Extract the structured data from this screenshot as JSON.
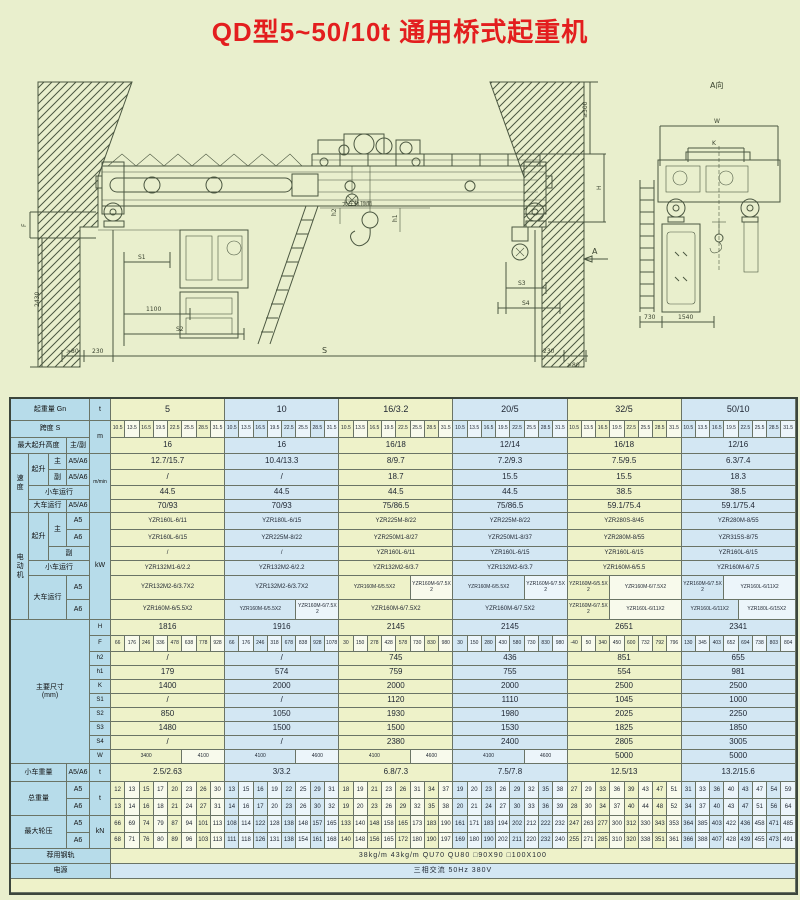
{
  "title": "QD型5~50/10t 通用桥式起重机",
  "drawing": {
    "view_a_label": "A向",
    "w": "W",
    "k": "K",
    "d730": "730",
    "d1540": "1540",
    "ge300": "≥300",
    "h": "H",
    "f": "F",
    "d2430": "2430",
    "s1": "S1",
    "d1100": "1100",
    "s2": "S2",
    "gt80l": ">80",
    "d230l": "230",
    "s": "S",
    "d230r": "230",
    "gt80r": ">80",
    "s3": "S3",
    "s4": "S4",
    "a": "A",
    "h1": "h1",
    "h2": "h2",
    "rail_top": "大车轨顶面"
  },
  "table": {
    "corner": {
      "capacity": "起重量 Gn"
    },
    "units": {
      "t": "t",
      "m": "m",
      "mmin": "m/min",
      "kw": "kW",
      "t2": "t",
      "t3": "t",
      "kn": "kN"
    },
    "labels": {
      "span": "跨度 S",
      "height": "最大起升高度",
      "main_aux": "主/副",
      "speed": "速度",
      "hoist": "起升",
      "main": "主",
      "aux": "副",
      "a56": "A5/A6",
      "a5": "A5",
      "a6": "A6",
      "trolley_travel": "小车运行",
      "crane_travel": "大车运行",
      "motor": "电动机",
      "dims": "主要尺寸\n(mm)",
      "trolley_weight": "小车重量",
      "total_weight": "总重量",
      "wheel_load": "最大轮压",
      "rail": "荐用钢轨",
      "power": "电源"
    },
    "dim_labels": [
      "H",
      "F",
      "h2",
      "h1",
      "K",
      "S1",
      "S2",
      "S3",
      "S4",
      "W"
    ],
    "spans": [
      "10.5",
      "13.5",
      "16.5",
      "19.5",
      "22.5",
      "25.5",
      "28.5",
      "31.5"
    ],
    "rows": {
      "capacities": [
        "5",
        "10",
        "16/3.2",
        "20/5",
        "32/5",
        "50/10"
      ],
      "height": [
        "16",
        "16",
        "16/18",
        "12/14",
        "16/18",
        "12/16"
      ],
      "speed_main": [
        "12.7/15.7",
        "10.4/13.3",
        "8/9.7",
        "7.2/9.3",
        "7.5/9.5",
        "6.3/7.4"
      ],
      "speed_aux": [
        "/",
        "/",
        "18.7",
        "15.5",
        "15.5",
        "18.3"
      ],
      "speed_trolley": [
        "44.5",
        "44.5",
        "44.5",
        "44.5",
        "38.5",
        "38.5"
      ],
      "speed_crane": [
        "70/93",
        "70/93",
        "75/86.5",
        "75/86.5",
        "59.1/75.4",
        "59.1/75.4"
      ],
      "motor_main_a5": [
        "YZR160L-6/11",
        "YZR180L-6/15",
        "YZR225M-8/22",
        "YZR225M-8/22",
        "YZR280S-8/45",
        "YZR280M-8/55"
      ],
      "motor_main_a6": [
        "YZR160L-6/15",
        "YZR225M-8/22",
        "YZR250M1-8/27",
        "YZR250M1-8/37",
        "YZR280M-8/55",
        "YZR315S-8/75"
      ],
      "motor_aux": [
        "/",
        "/",
        "YZR160L-6/11",
        "YZR160L-6/15",
        "YZR160L-6/15",
        "YZR160L-6/15"
      ],
      "motor_trolley": [
        "YZR132M1-6/2.2",
        "YZR132M2-6/2.2",
        "YZR132M2-6/3.7",
        "YZR132M2-6/3.7",
        "YZR160M-6/5.5",
        "YZR160M-6/7.5"
      ],
      "motor_crane_a5": [
        [
          "YZR132M2-6/3.7X2"
        ],
        [
          "YZR132M2-6/3.7X2"
        ],
        [
          "YZR160M-6/5.5X2",
          "YZR160M-6/7.5X2"
        ],
        [
          "YZR160M-6/5.5X2",
          "YZR160M-6/7.5X2"
        ],
        [
          "YZR160M-6/5.5X2",
          "YZR160M-6/7.5X2"
        ],
        [
          "YZR160M-6/7.5X2",
          "YZR160L-6/11X2"
        ]
      ],
      "motor_crane_a6": [
        [
          "YZR160M-6/5.5X2"
        ],
        [
          "YZR160M-6/5.5X2",
          "YZR160M-6/7.5X2"
        ],
        [
          "YZR160M-6/7.5X2"
        ],
        [
          "YZR160M-6/7.5X2"
        ],
        [
          "YZR160M-6/7.5X2",
          "YZR160L-6/11X2"
        ],
        [
          "YZR160L-6/11X2",
          "YZR180L-6/15X2"
        ]
      ],
      "H": [
        "1816",
        "1916",
        "2145",
        "2145",
        "2651",
        "2341"
      ],
      "F": [
        [
          "66",
          "176",
          "246",
          "336",
          "478",
          "638",
          "778",
          "928"
        ],
        [
          "66",
          "176",
          "246",
          "318",
          "678",
          "838",
          "928",
          "1078"
        ],
        [
          "30",
          "150",
          "278",
          "428",
          "578",
          "730",
          "830",
          "980"
        ],
        [
          "30",
          "150",
          "280",
          "430",
          "580",
          "730",
          "830",
          "980"
        ],
        [
          "-40",
          "50",
          "340",
          "450",
          "600",
          "732",
          "792",
          "796"
        ],
        [
          "130",
          "345",
          "403",
          "652",
          "694",
          "738",
          "803",
          "804"
        ]
      ],
      "h2": [
        "/",
        "/",
        "745",
        "436",
        "851",
        "655"
      ],
      "h1": [
        "179",
        "574",
        "759",
        "755",
        "554",
        "981"
      ],
      "K": [
        "1400",
        "2000",
        "2000",
        "2000",
        "2500",
        "2500"
      ],
      "S1": [
        "/",
        "/",
        "1120",
        "1110",
        "1045",
        "1000"
      ],
      "S2": [
        "850",
        "1050",
        "1930",
        "1980",
        "2025",
        "2250"
      ],
      "S3": [
        "1480",
        "1500",
        "1500",
        "1530",
        "1825",
        "1850"
      ],
      "S4": [
        "/",
        "/",
        "2380",
        "2400",
        "2805",
        "3005"
      ],
      "W": [
        [
          "3400",
          "4100"
        ],
        [
          "4100",
          "4600"
        ],
        [
          "4100",
          "4600"
        ],
        [
          "4100",
          "4600"
        ],
        [
          "5000"
        ],
        [
          "5000"
        ]
      ],
      "trolley_weight": [
        "2.5/2.63",
        "3/3.2",
        "6.8/7.3",
        "7.5/7.8",
        "12.5/13",
        "13.2/15.6"
      ],
      "total_a5": [
        [
          "12",
          "13",
          "15",
          "17",
          "20",
          "23",
          "26",
          "30"
        ],
        [
          "13",
          "15",
          "16",
          "19",
          "22",
          "25",
          "29",
          "31"
        ],
        [
          "18",
          "19",
          "21",
          "23",
          "26",
          "31",
          "34",
          "37"
        ],
        [
          "19",
          "20",
          "23",
          "26",
          "29",
          "32",
          "35",
          "38"
        ],
        [
          "27",
          "29",
          "33",
          "36",
          "39",
          "43",
          "47",
          "51"
        ],
        [
          "31",
          "33",
          "36",
          "40",
          "43",
          "47",
          "54",
          "59"
        ]
      ],
      "total_a6": [
        [
          "13",
          "14",
          "16",
          "18",
          "21",
          "24",
          "27",
          "31"
        ],
        [
          "14",
          "16",
          "17",
          "20",
          "23",
          "26",
          "30",
          "32"
        ],
        [
          "19",
          "20",
          "23",
          "26",
          "29",
          "32",
          "35",
          "38"
        ],
        [
          "20",
          "21",
          "24",
          "27",
          "30",
          "33",
          "36",
          "39"
        ],
        [
          "28",
          "30",
          "34",
          "37",
          "40",
          "44",
          "48",
          "52"
        ],
        [
          "34",
          "37",
          "40",
          "43",
          "47",
          "51",
          "56",
          "64"
        ]
      ],
      "wheel_a5": [
        [
          "66",
          "69",
          "74",
          "79",
          "87",
          "94",
          "101",
          "113"
        ],
        [
          "108",
          "114",
          "122",
          "128",
          "138",
          "148",
          "157",
          "165"
        ],
        [
          "133",
          "140",
          "148",
          "158",
          "165",
          "173",
          "183",
          "190"
        ],
        [
          "161",
          "171",
          "183",
          "194",
          "202",
          "212",
          "222",
          "232"
        ],
        [
          "247",
          "263",
          "277",
          "300",
          "312",
          "330",
          "343",
          "353"
        ],
        [
          "364",
          "385",
          "403",
          "422",
          "436",
          "458",
          "471",
          "485"
        ]
      ],
      "wheel_a6": [
        [
          "68",
          "71",
          "76",
          "80",
          "89",
          "96",
          "103",
          "113"
        ],
        [
          "111",
          "118",
          "126",
          "131",
          "138",
          "154",
          "161",
          "168"
        ],
        [
          "140",
          "148",
          "156",
          "165",
          "172",
          "180",
          "190",
          "197"
        ],
        [
          "169",
          "180",
          "190",
          "202",
          "211",
          "220",
          "232",
          "240"
        ],
        [
          "255",
          "271",
          "285",
          "310",
          "320",
          "338",
          "351",
          "361"
        ],
        [
          "366",
          "388",
          "407",
          "428",
          "439",
          "455",
          "473",
          "491"
        ]
      ],
      "rail_text": "38kg/m   43kg/m   QU70   QU80   □90X90   □100X100",
      "power_text": "三相交流   50Hz   380V"
    }
  }
}
